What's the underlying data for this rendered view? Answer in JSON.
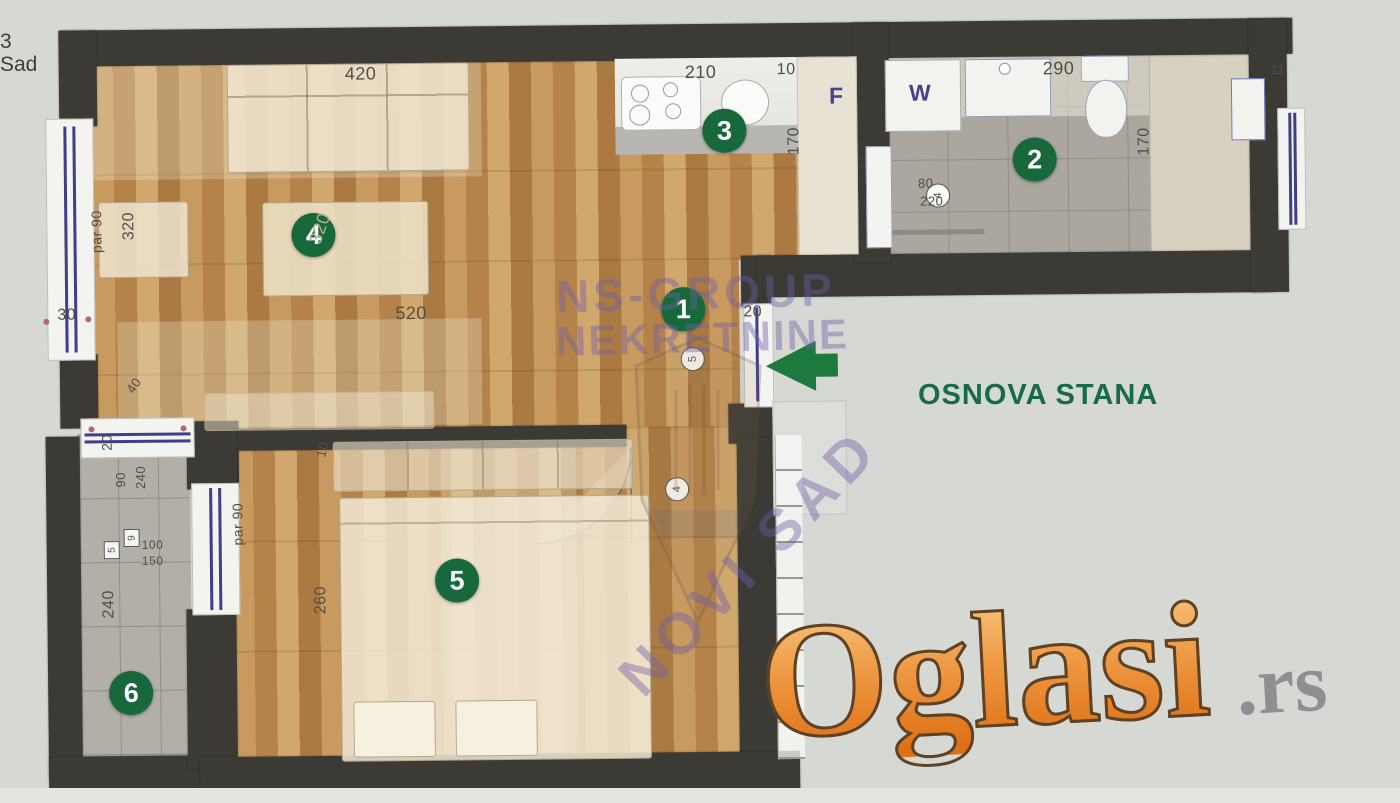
{
  "corner": {
    "line1": "3",
    "line2": "Sad"
  },
  "title": "OSNOVA STANA",
  "watermarks": {
    "agency_name": "NS-GROUP",
    "agency_word": "NEKRETNINE",
    "agency_city": "NOVI SAD",
    "portal_name": "Oglasi",
    "portal_tld": ".rs"
  },
  "rooms": [
    {
      "number": "1"
    },
    {
      "number": "2"
    },
    {
      "number": "3"
    },
    {
      "number": "4"
    },
    {
      "number": "5"
    },
    {
      "number": "6"
    }
  ],
  "appliance_labels": {
    "fridge": "F",
    "washer": "W"
  },
  "dims": {
    "sofa": "420",
    "kitchen": "210",
    "kitchen_gap": "10",
    "bathroom": "290",
    "right_wall": "11",
    "kitchen_depth": "170",
    "bathroom_depth": "170",
    "living_window": "320",
    "table": "320",
    "living_length": "520",
    "parapet": "par 90",
    "window_sill": "30",
    "entrance": "20",
    "bath_fix_a": "80",
    "bath_fix_b": "220",
    "terrace_a": "90",
    "terrace_b": "240",
    "terrace_c": "100",
    "terrace_d": "150",
    "terrace_len": "240",
    "bed_depth": "260",
    "bed_top": "10",
    "mid_win_a": "20",
    "mid_win_b": "40"
  },
  "door_markers": {
    "hall": "5",
    "bedroom": "4",
    "bathroom": "4",
    "box_a": "5",
    "box_b": "9"
  },
  "colors": {
    "badge_green": "#17693c",
    "title_green": "#176a4a",
    "watermark_purple": "#6e5ea6",
    "portal_orange": "#e8873a",
    "wall": "#3b3a35",
    "arrow_green": "#1d7a3f"
  }
}
